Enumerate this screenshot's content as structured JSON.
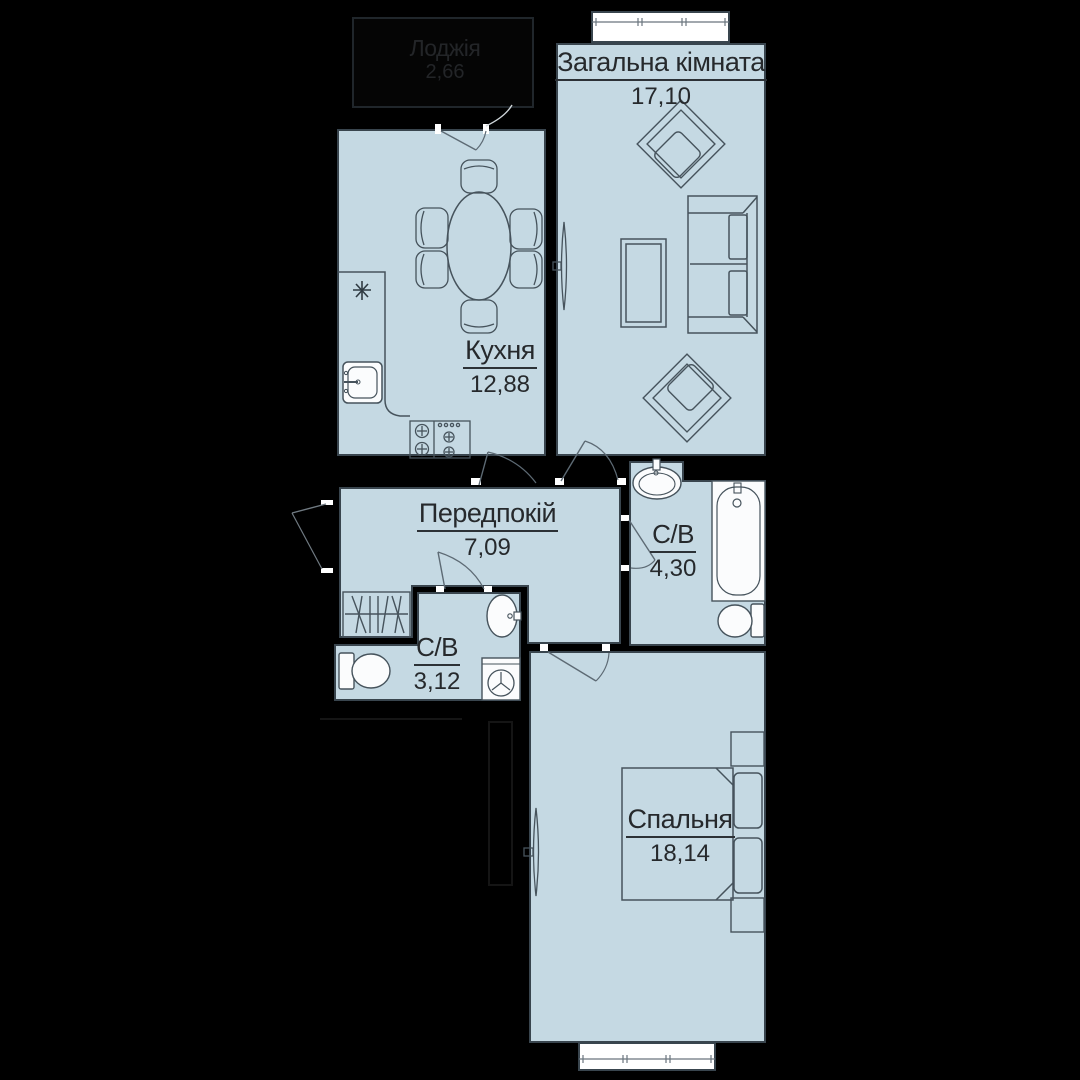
{
  "plan": {
    "colors": {
      "background": "#000000",
      "floor": "#c5d9e3",
      "wall_outline": "#39454e",
      "furniture_line": "#46535c",
      "fixture_white": "#fbfcfd",
      "label_text": "#26292c"
    },
    "rooms": [
      {
        "id": "living",
        "name": "Загальна кімната",
        "area": "17,10"
      },
      {
        "id": "kitchen",
        "name": "Кухня",
        "area": "12,88"
      },
      {
        "id": "hallway",
        "name": "Передпокій",
        "area": "7,09"
      },
      {
        "id": "bathroom_main",
        "name": "С/В",
        "area": "4,30"
      },
      {
        "id": "bathroom_small",
        "name": "С/В",
        "area": "3,12"
      },
      {
        "id": "bedroom",
        "name": "Спальня",
        "area": "18,14"
      },
      {
        "id": "loggia",
        "name": "Лоджія",
        "area": "2,66"
      }
    ],
    "fixtures": [
      {
        "type": "window",
        "room": "living"
      },
      {
        "type": "window",
        "room": "bedroom"
      },
      {
        "type": "sofa",
        "room": "living"
      },
      {
        "type": "coffee-table",
        "room": "living"
      },
      {
        "type": "armchair",
        "room": "living"
      },
      {
        "type": "armchair",
        "room": "living"
      },
      {
        "type": "radiator",
        "room": "living"
      },
      {
        "type": "dining-table",
        "room": "kitchen"
      },
      {
        "type": "chair",
        "room": "kitchen"
      },
      {
        "type": "kitchen-counter",
        "room": "kitchen"
      },
      {
        "type": "kitchen-sink",
        "room": "kitchen"
      },
      {
        "type": "stove",
        "room": "kitchen"
      },
      {
        "type": "wardrobe",
        "room": "hallway"
      },
      {
        "type": "toilet",
        "room": "bathroom_small"
      },
      {
        "type": "wash-basin",
        "room": "bathroom_small"
      },
      {
        "type": "washing-machine",
        "room": "bathroom_small"
      },
      {
        "type": "wash-basin",
        "room": "bathroom_main"
      },
      {
        "type": "bathtub",
        "room": "bathroom_main"
      },
      {
        "type": "toilet",
        "room": "bathroom_main"
      },
      {
        "type": "bed",
        "room": "bedroom"
      },
      {
        "type": "nightstand",
        "room": "bedroom"
      },
      {
        "type": "nightstand",
        "room": "bedroom"
      },
      {
        "type": "radiator",
        "room": "bedroom"
      }
    ]
  }
}
